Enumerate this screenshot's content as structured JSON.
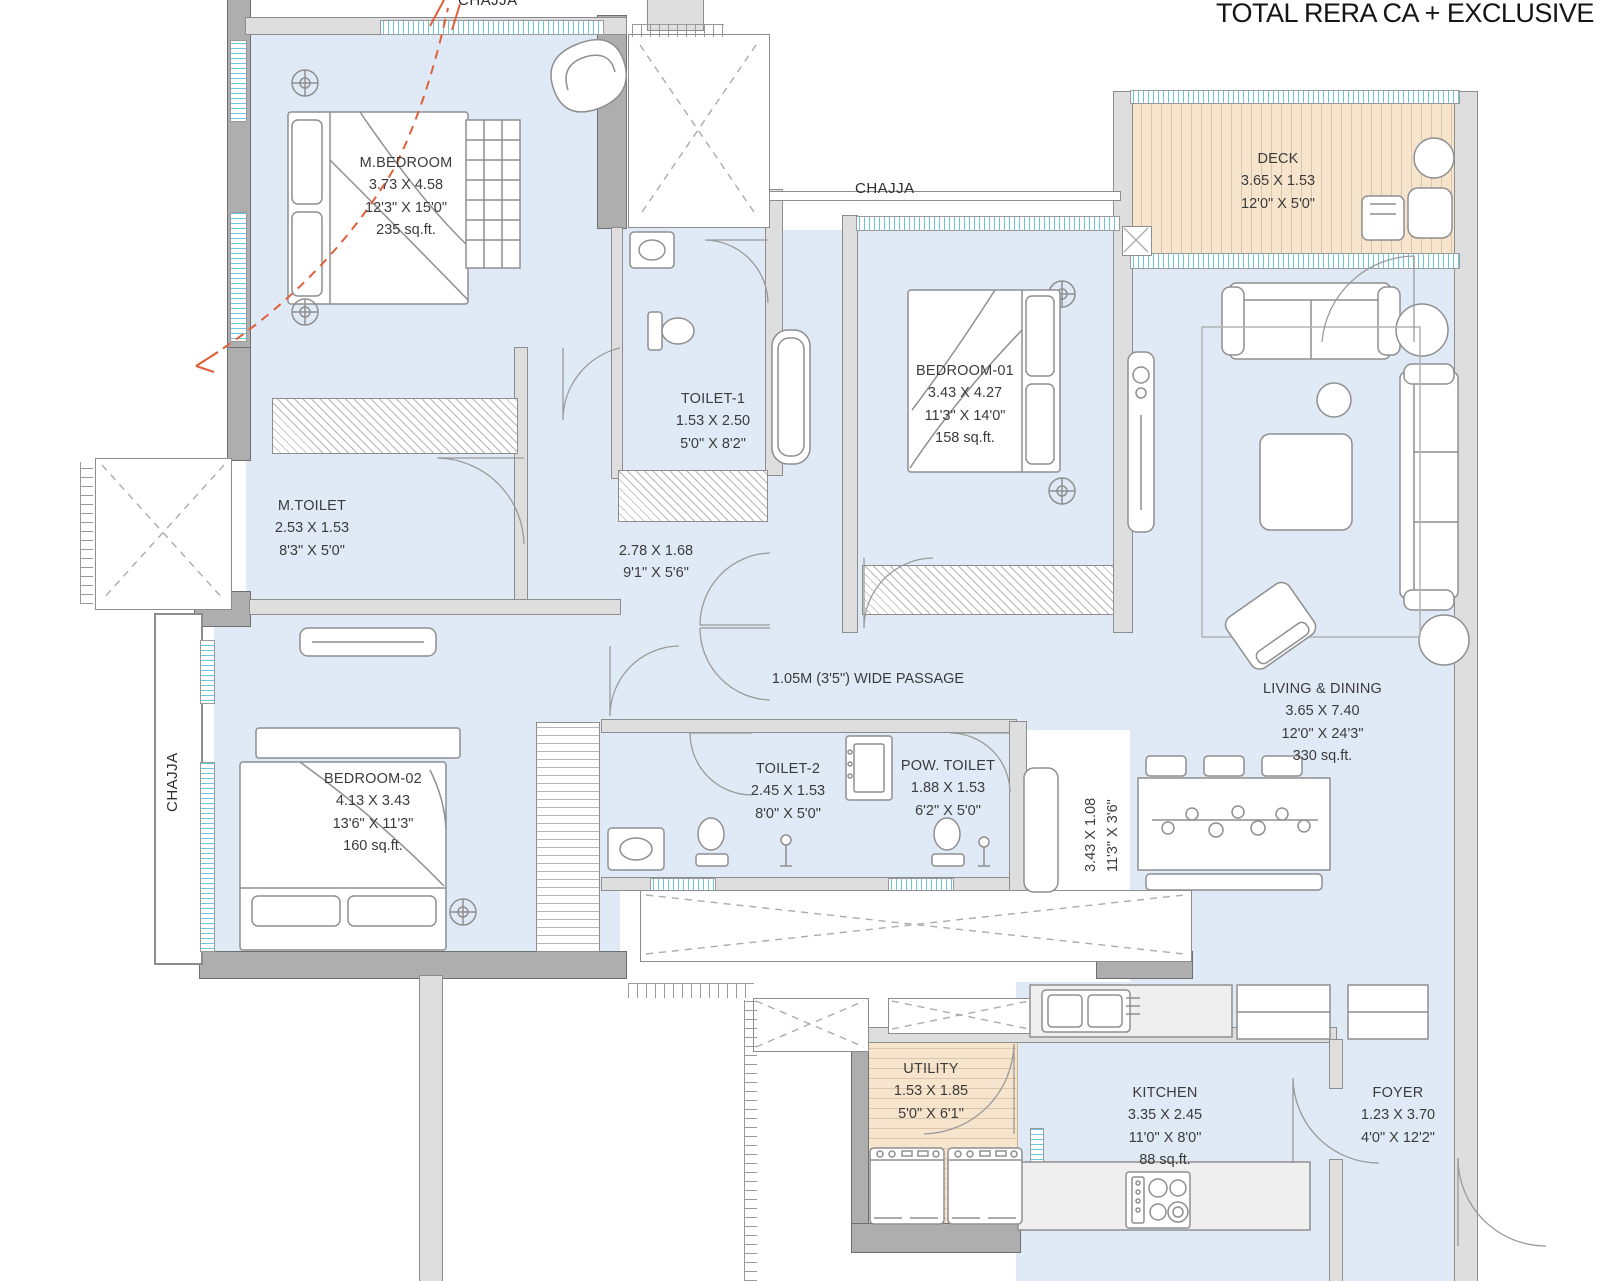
{
  "title": "TOTAL RERA CA + EXCLUSIVE CA",
  "chajja": {
    "top_left": "CHAJJA",
    "top_center": "CHAJJA",
    "left": "CHAJJA"
  },
  "passage_note": "1.05M (3'5\") WIDE PASSAGE",
  "rooms": {
    "m_bedroom": {
      "name": "M.BEDROOM",
      "m": "3.73 X 4.58",
      "ft": "12'3\" X 15'0\"",
      "area": "235 sq.ft."
    },
    "toilet_1": {
      "name": "TOILET-1",
      "m": "1.53 X 2.50",
      "ft": "5'0\" X 8'2\""
    },
    "m_toilet": {
      "name": "M.TOILET",
      "m": "2.53 X 1.53",
      "ft": "8'3\" X 5'0\""
    },
    "inner_passage": {
      "m": "2.78 X 1.68",
      "ft": "9'1\" X 5'6\""
    },
    "bedroom_01": {
      "name": "BEDROOM-01",
      "m": "3.43 X 4.27",
      "ft": "11'3\" X 14'0\"",
      "area": "158 sq.ft."
    },
    "deck": {
      "name": "DECK",
      "m": "3.65 X 1.53",
      "ft": "12'0\" X 5'0\""
    },
    "living_dining": {
      "name": "LIVING & DINING",
      "m": "3.65 X 7.40",
      "ft": "12'0\" X 24'3\"",
      "area": "330 sq.ft."
    },
    "dining_nook": {
      "m": "3.43 X 1.08",
      "ft": "11'3\" X 3'6\""
    },
    "bedroom_02": {
      "name": "BEDROOM-02",
      "m": "4.13 X 3.43",
      "ft": "13'6\" X 11'3\"",
      "area": "160 sq.ft."
    },
    "toilet_2": {
      "name": "TOILET-2",
      "m": "2.45 X 1.53",
      "ft": "8'0\" X 5'0\""
    },
    "pow_toilet": {
      "name": "POW. TOILET",
      "m": "1.88 X 1.53",
      "ft": "6'2\" X 5'0\""
    },
    "utility": {
      "name": "UTILITY",
      "m": "1.53 X 1.85",
      "ft": "5'0\" X 6'1\""
    },
    "kitchen": {
      "name": "KITCHEN",
      "m": "3.35 X 2.45",
      "ft": "11'0\" X 8'0\"",
      "area": "88 sq.ft."
    },
    "foyer": {
      "name": "FOYER",
      "m": "1.23 X 3.70",
      "ft": "4'0\" X 12'2\""
    }
  },
  "colors": {
    "room_fill": "#dfeaf6",
    "deck_fill": "#f6e4cd",
    "wall_dark": "#aeaeae",
    "wall_light": "#dedede",
    "window_accent": "#6cc7de",
    "arrow": "#e0603c"
  }
}
